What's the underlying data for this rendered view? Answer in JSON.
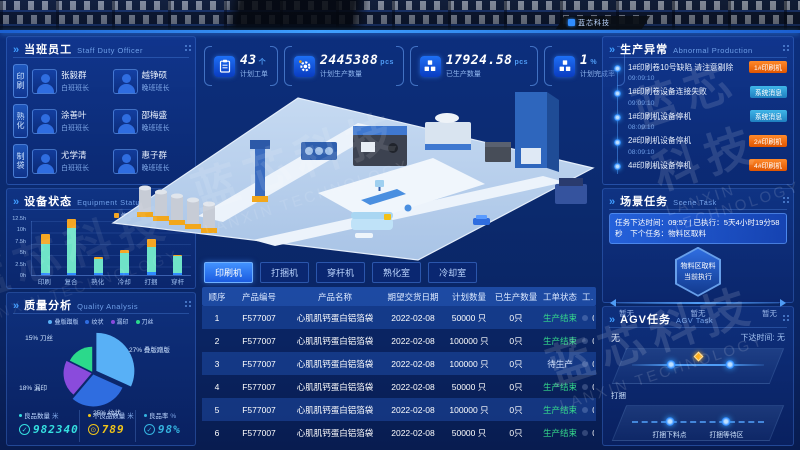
{
  "brand": {
    "logo_text": "蓝芯科技",
    "watermark_cn": "蓝芯科技",
    "watermark_en": "LANXIN TECHNOLOGY"
  },
  "staff": {
    "title": "当班员工",
    "subtitle": "Staff Duty Officer",
    "groups": [
      {
        "tag": "印刷",
        "members": [
          {
            "name": "张毅群",
            "role": "白班班长"
          },
          {
            "name": "越铮硕",
            "role": "晚班班长"
          }
        ]
      },
      {
        "tag": "熟化",
        "members": [
          {
            "name": "涂善叶",
            "role": "白班班长"
          },
          {
            "name": "邵梅盛",
            "role": "晚班班长"
          }
        ]
      },
      {
        "tag": "制袋",
        "members": [
          {
            "name": "尤学清",
            "role": "白班班长"
          },
          {
            "name": "惠子群",
            "role": "晚班班长"
          }
        ]
      }
    ]
  },
  "equipment": {
    "title": "设备状态",
    "subtitle": "Equipment Status"
  },
  "quality": {
    "title": "质量分析",
    "subtitle": "Quality Analysis",
    "stats": [
      {
        "label": "良品数量",
        "unit": "米",
        "value": "982340",
        "color": "#35e0e0",
        "icon": "check-circle-icon",
        "glyph": "✓"
      },
      {
        "label": "不良品数量",
        "unit": "米",
        "value": "789",
        "color": "#f0c419",
        "icon": "target-circle-icon",
        "glyph": "⊙"
      },
      {
        "label": "良品率",
        "unit": "%",
        "value": "98%",
        "color": "#35b4e0",
        "icon": "check-circle-icon",
        "glyph": "✓"
      }
    ]
  },
  "kpis": [
    {
      "icon": "clipboard-icon",
      "value": "43",
      "unit": "个",
      "label": "计划工单"
    },
    {
      "icon": "gear-icon",
      "value": "2445388",
      "unit": "pcs",
      "label": "计划生产数量"
    },
    {
      "icon": "boxes-icon",
      "value": "17924.58",
      "unit": "pcs",
      "label": "已生产数量"
    },
    {
      "icon": "boxes-icon",
      "value": "1",
      "unit": "%",
      "label": "计划完成率"
    }
  ],
  "tabs": [
    {
      "label": "印刷机",
      "active": true
    },
    {
      "label": "打捆机",
      "active": false
    },
    {
      "label": "穿杆机",
      "active": false
    },
    {
      "label": "熟化室",
      "active": false
    },
    {
      "label": "冷却室",
      "active": false
    }
  ],
  "table": {
    "headers": [
      "顺序",
      "产品编号",
      "产品名称",
      "期望交货日期",
      "计划数量",
      "已生产数量",
      "工单状态",
      "工单完成率"
    ],
    "rows": [
      {
        "seq": "1",
        "code": "F577007",
        "name": "心肌肌钙蛋白铝箔袋",
        "date": "2022-02-08",
        "plan": "50000 只",
        "produced": "0只",
        "status": "生产结束",
        "status_type": "done",
        "rate": "0%"
      },
      {
        "seq": "2",
        "code": "F577007",
        "name": "心肌肌钙蛋白铝箔袋",
        "date": "2022-02-08",
        "plan": "100000 只",
        "produced": "0只",
        "status": "生产结束",
        "status_type": "done",
        "rate": "0%"
      },
      {
        "seq": "3",
        "code": "F577007",
        "name": "心肌肌钙蛋白铝箔袋",
        "date": "2022-02-08",
        "plan": "100000 只",
        "produced": "0只",
        "status": "待生产",
        "status_type": "wait",
        "rate": "0%"
      },
      {
        "seq": "4",
        "code": "F577007",
        "name": "心肌肌钙蛋白铝箔袋",
        "date": "2022-02-08",
        "plan": "50000 只",
        "produced": "0只",
        "status": "生产结束",
        "status_type": "done",
        "rate": "0%"
      },
      {
        "seq": "5",
        "code": "F577007",
        "name": "心肌肌钙蛋白铝箔袋",
        "date": "2022-02-08",
        "plan": "100000 只",
        "produced": "0只",
        "status": "生产结束",
        "status_type": "done",
        "rate": "0%"
      },
      {
        "seq": "6",
        "code": "F577007",
        "name": "心肌肌钙蛋白铝箔袋",
        "date": "2022-02-08",
        "plan": "50000 只",
        "produced": "0只",
        "status": "生产结束",
        "status_type": "done",
        "rate": "0%"
      }
    ]
  },
  "abnormal": {
    "title": "生产异常",
    "subtitle": "Abnormal Production",
    "items": [
      {
        "text": "1#印刷卷10号缺陷 请注意剔除",
        "time": "09:09:10",
        "tag": "1#印刷机",
        "type": "alarm"
      },
      {
        "text": "1#印刷卷设备连接失败",
        "time": "09:09:10",
        "tag": "系统消息",
        "type": "info"
      },
      {
        "text": "1#印刷机设备停机",
        "time": "08:09:10",
        "tag": "系统消息",
        "type": "info"
      },
      {
        "text": "2#印刷机设备停机",
        "time": "08:09:10",
        "tag": "2#印刷机",
        "type": "alarm"
      },
      {
        "text": "4#印刷机设备停机",
        "time": "",
        "tag": "4#印刷机",
        "type": "alarm"
      }
    ]
  },
  "scene": {
    "title": "场景任务",
    "subtitle": "Scene Task",
    "banner": "任务下达时间：09:57 | 已执行：5天4小时19分58秒　下个任务：物料区取料",
    "hex_title": "物料区取料",
    "hex_sub": "当前执行",
    "slots": [
      "暂无",
      "暂无",
      "暂无"
    ]
  },
  "agv": {
    "title": "AGV任务",
    "subtitle": "AGV Task",
    "current": "无",
    "issued_label": "下达时间:",
    "issued_value": "无",
    "group_label": "打捆",
    "stops": [
      "打捆下料点",
      "打捆等待区"
    ]
  },
  "chart_data": [
    {
      "type": "bar",
      "title": "设备状态",
      "stacked": true,
      "grid": true,
      "categories": [
        "印刷",
        "复合",
        "熟化",
        "冷却",
        "打捆",
        "穿杆"
      ],
      "series": [
        {
          "name": "待机",
          "color": "#2e8bff",
          "values": [
            0.5,
            0.5,
            0.5,
            0.5,
            0.7,
            0.5
          ]
        },
        {
          "name": "运行中",
          "color": "#6fe3c8",
          "values": [
            6.2,
            9.8,
            3.0,
            4.4,
            5.5,
            3.7
          ]
        },
        {
          "name": "停机",
          "color": "#f5a623",
          "values": [
            2.3,
            2.0,
            0.4,
            0.6,
            1.8,
            0.3
          ]
        }
      ],
      "legend": [
        "停机",
        "运行中",
        "待机"
      ],
      "legend_position": "top-right",
      "yticks": [
        "0h",
        "2.5h",
        "5h",
        "7.5h",
        "10h",
        "12.5h"
      ],
      "ylim": [
        0,
        12.5
      ]
    },
    {
      "type": "pie",
      "title": "质量分析",
      "legend_position": "top",
      "slices": [
        {
          "label": "叠版蹭版",
          "percent": 27,
          "color": "#58b0f6"
        },
        {
          "label": "纹状",
          "percent": 25,
          "color": "#2f6de0"
        },
        {
          "label": "漏印",
          "percent": 18,
          "color": "#8a4bdc"
        },
        {
          "label": "刀丝",
          "percent": 15,
          "color": "#2bd98b"
        }
      ]
    }
  ]
}
